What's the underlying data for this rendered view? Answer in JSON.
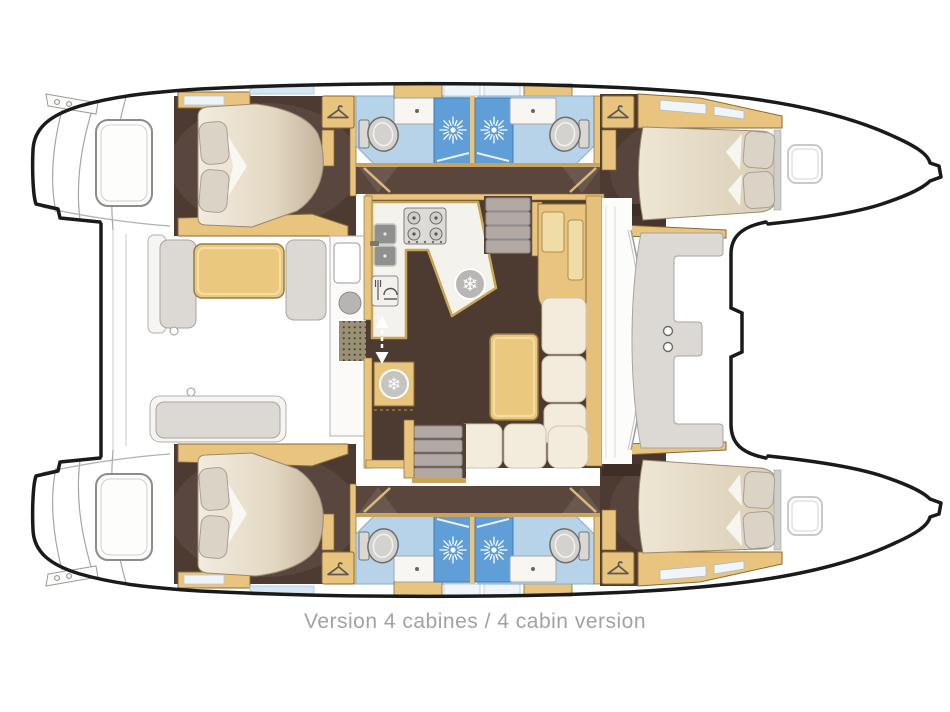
{
  "diagram": {
    "caption": "Version 4 cabines / 4 cabin version",
    "subject": "catamaran-4-cabin-layout-plan"
  },
  "icons": {
    "snowflake_glyph": "❄",
    "names": [
      "shower-starburst-icon",
      "snowflake-fridge-icon",
      "hanger-wardrobe-icon",
      "stove-burners-icon",
      "double-sink-icon",
      "oven-icon",
      "toilet-icon",
      "sliding-door-arrow-icon",
      "dot-mat",
      "deck-hatch"
    ]
  },
  "palette": {
    "floor_brown": "#4d3a31",
    "corridor_brown": "#5a463c",
    "wood": "#e8c47e",
    "wood_dark": "#8a6a33",
    "wood_light": "#f3dea6",
    "counter_white": "#f4f2ec",
    "bathroom_blue": "#b7d3ea",
    "shower_blue": "#5f9ed6",
    "bench_gray": "#dcd9d4",
    "cushion_cream": "#f3ecdc",
    "mattress_light": "#f1ebdd",
    "mattress_dark": "#c4b29a",
    "pillow": "#dad3c6",
    "toilet_gray": "#d3d2cf",
    "outline_black": "#1a1a1a",
    "line_gray": "#9a9a9a",
    "caption_gray": "#a2a2a2",
    "window_blue": "#d6e7f4",
    "mat_olive": "#9a9175"
  }
}
